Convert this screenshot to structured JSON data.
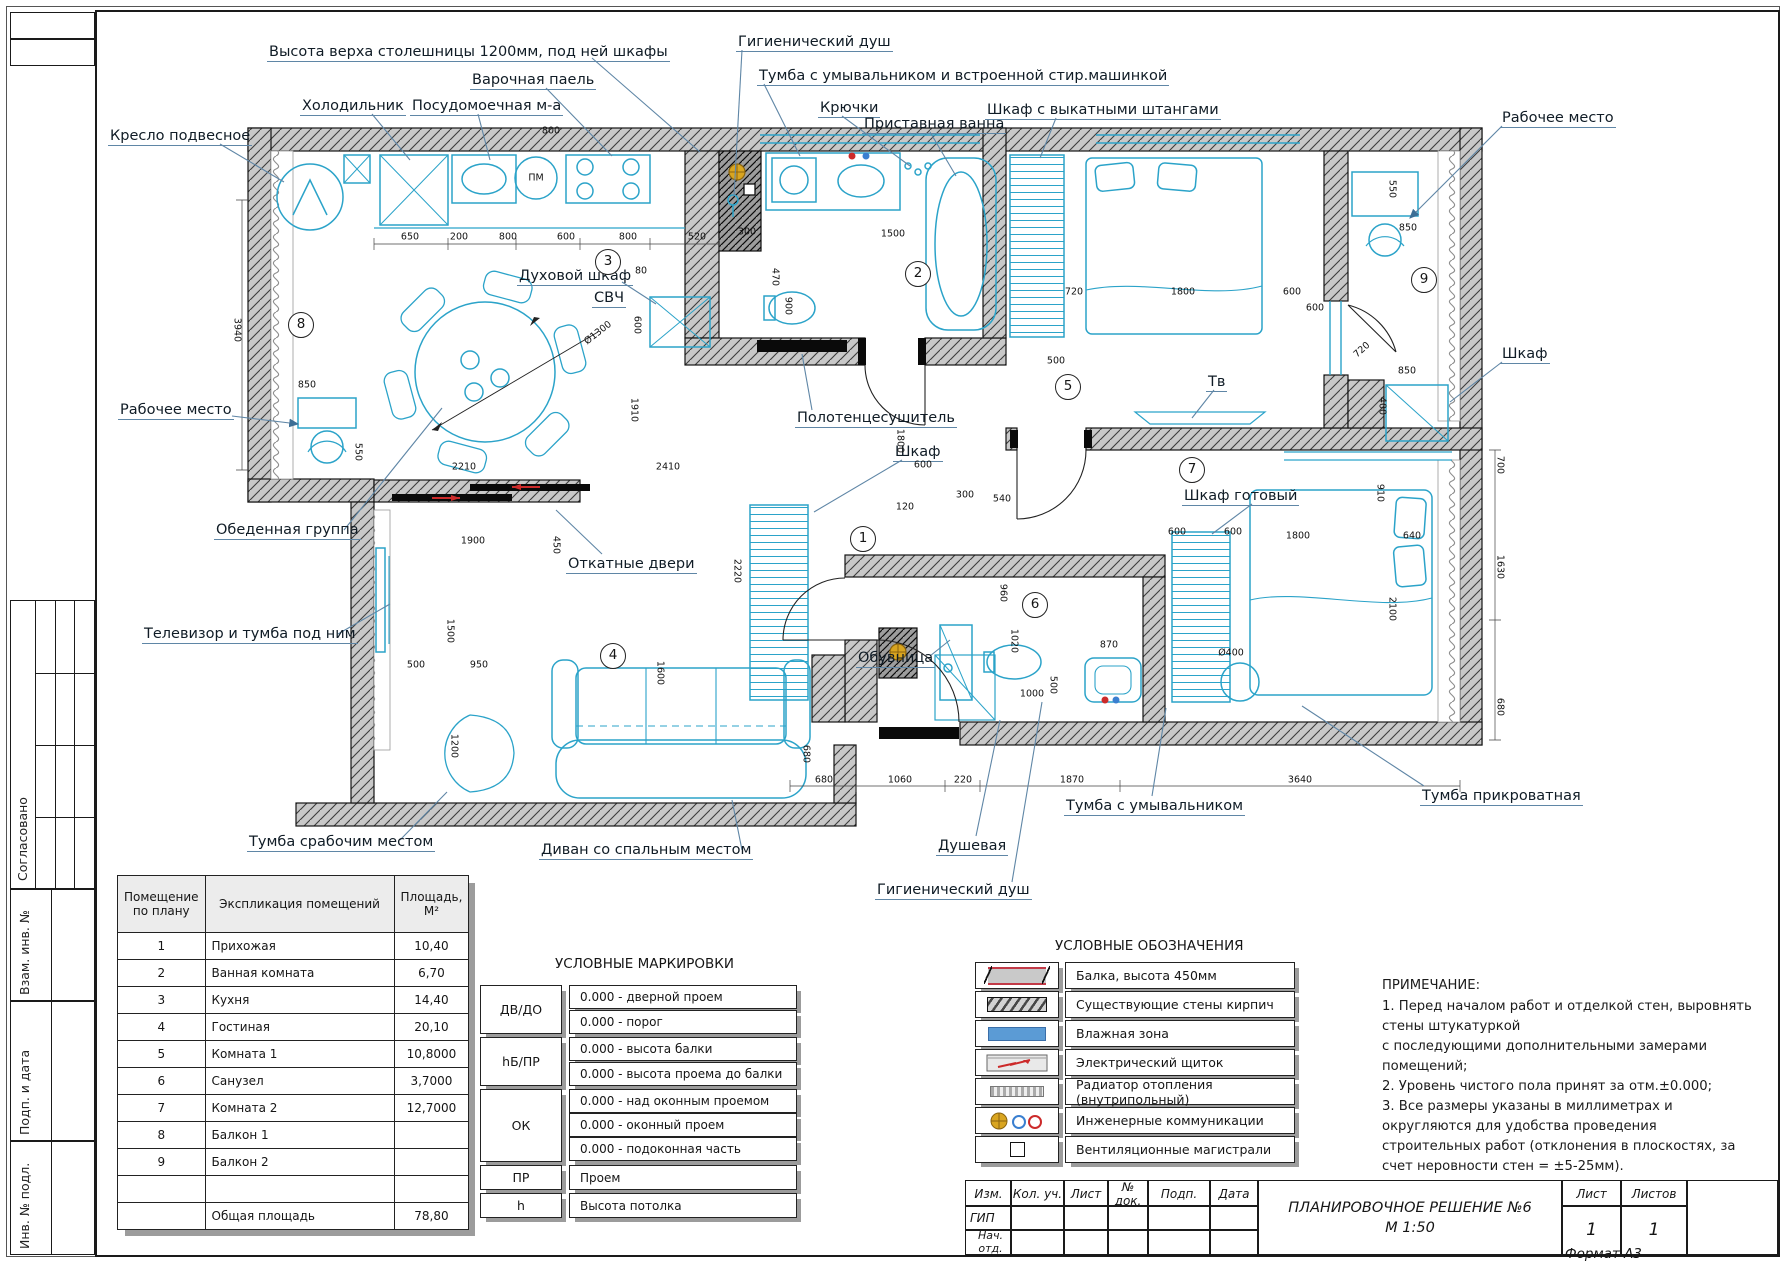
{
  "drawing": {
    "title_line1": "ПЛАНИРОВОЧНОЕ РЕШЕНИЕ №6",
    "title_line2": "М 1:50",
    "format": "Формат А3"
  },
  "stamp_left": {
    "approved": "Согласовано",
    "vzam": "Взам. инв. №",
    "podp": "Подп. и дата",
    "inv": "Инв. № подл."
  },
  "callouts": [
    {
      "t": "Высота верха столешницы 1200мм, под ней шкафы",
      "x": 267,
      "y": 44,
      "sx": 592,
      "sy": 58,
      "tx": 700,
      "ty": 152
    },
    {
      "t": "Гигиенический душ",
      "x": 736,
      "y": 34,
      "sx": 742,
      "sy": 50,
      "tx": 734,
      "ty": 196
    },
    {
      "t": "Тумба с умывальником и встроенной стир.машинкой",
      "x": 757,
      "y": 68,
      "sx": 764,
      "sy": 84,
      "tx": 800,
      "ty": 156
    },
    {
      "t": "Варочная паель",
      "x": 470,
      "y": 72,
      "sx": 546,
      "sy": 88,
      "tx": 612,
      "ty": 156
    },
    {
      "t": "Холодильник",
      "x": 300,
      "y": 98,
      "sx": 372,
      "sy": 114,
      "tx": 410,
      "ty": 160
    },
    {
      "t": "Посудомоечная м-а",
      "x": 410,
      "y": 98,
      "sx": 478,
      "sy": 114,
      "tx": 490,
      "ty": 160
    },
    {
      "t": "Крючки",
      "x": 818,
      "y": 100,
      "sx": 842,
      "sy": 116,
      "tx": 910,
      "ty": 166
    },
    {
      "t": "Приставная ванна",
      "x": 862,
      "y": 116,
      "sx": 930,
      "sy": 132,
      "tx": 956,
      "ty": 176
    },
    {
      "t": "Шкаф с выкатными штангами",
      "x": 985,
      "y": 102,
      "sx": 1056,
      "sy": 118,
      "tx": 1040,
      "ty": 158
    },
    {
      "t": "Рабочее место",
      "x": 1500,
      "y": 110,
      "sx": 1502,
      "sy": 126,
      "tx": 1410,
      "ty": 218,
      "a": 1
    },
    {
      "t": "Кресло подвесное",
      "x": 108,
      "y": 128,
      "sx": 220,
      "sy": 144,
      "tx": 284,
      "ty": 182
    },
    {
      "t": "Духовой шкаф",
      "x": 517,
      "y": 268,
      "sx": 622,
      "sy": 282,
      "tx": 656,
      "ty": 304
    },
    {
      "t": "СВЧ",
      "x": 592,
      "y": 290
    },
    {
      "t": "Рабочее место",
      "x": 118,
      "y": 402,
      "sx": 232,
      "sy": 416,
      "tx": 298,
      "ty": 424,
      "a": 1
    },
    {
      "t": "Полотенцесушитель",
      "x": 795,
      "y": 410,
      "sx": 812,
      "sy": 410,
      "tx": 802,
      "ty": 354
    },
    {
      "t": "Шкаф",
      "x": 893,
      "y": 444,
      "sx": 902,
      "sy": 460,
      "tx": 814,
      "ty": 512
    },
    {
      "t": "Тв",
      "x": 1206,
      "y": 374,
      "sx": 1214,
      "sy": 390,
      "tx": 1192,
      "ty": 418
    },
    {
      "t": "Шкаф",
      "x": 1500,
      "y": 346,
      "sx": 1502,
      "sy": 362,
      "tx": 1450,
      "ty": 402
    },
    {
      "t": "Обеденная группа",
      "x": 214,
      "y": 522,
      "sx": 344,
      "sy": 530,
      "tx": 442,
      "ty": 408
    },
    {
      "t": "Откатные двери",
      "x": 566,
      "y": 556,
      "sx": 602,
      "sy": 554,
      "tx": 556,
      "ty": 510
    },
    {
      "t": "Шкаф готовый",
      "x": 1182,
      "y": 488,
      "sx": 1252,
      "sy": 504,
      "tx": 1212,
      "ty": 534
    },
    {
      "t": "Телевизор и тумба под ним",
      "x": 142,
      "y": 626,
      "sx": 338,
      "sy": 634,
      "tx": 390,
      "ty": 604
    },
    {
      "t": "Обувница",
      "x": 856,
      "y": 650,
      "sx": 930,
      "sy": 656,
      "tx": 950,
      "ty": 640
    },
    {
      "t": "Тумба срабочим местом",
      "x": 247,
      "y": 834,
      "sx": 400,
      "sy": 840,
      "tx": 447,
      "ty": 792
    },
    {
      "t": "Диван со  спальным местом",
      "x": 539,
      "y": 842,
      "sx": 742,
      "sy": 850,
      "tx": 732,
      "ty": 800
    },
    {
      "t": "Душевая",
      "x": 936,
      "y": 838,
      "sx": 976,
      "sy": 836,
      "tx": 1000,
      "ty": 720
    },
    {
      "t": "Гигиенический душ",
      "x": 875,
      "y": 882,
      "sx": 1012,
      "sy": 882,
      "tx": 1042,
      "ty": 702
    },
    {
      "t": "Тумба с умывальником",
      "x": 1064,
      "y": 798,
      "sx": 1152,
      "sy": 796,
      "tx": 1166,
      "ty": 708
    },
    {
      "t": "Тумба прикроватная",
      "x": 1420,
      "y": 788,
      "sx": 1424,
      "sy": 786,
      "tx": 1302,
      "ty": 706
    }
  ],
  "rooms": [
    [
      "1",
      862,
      538
    ],
    [
      "2",
      917,
      273
    ],
    [
      "3",
      607,
      261
    ],
    [
      "4",
      612,
      655
    ],
    [
      "5",
      1067,
      386
    ],
    [
      "6",
      1034,
      604
    ],
    [
      "7",
      1191,
      469
    ],
    [
      "8",
      300,
      324
    ],
    [
      "9",
      1423,
      279
    ]
  ],
  "dims": [
    [
      "650",
      410,
      237,
      0
    ],
    [
      "200",
      459,
      237,
      0
    ],
    [
      "800",
      508,
      237,
      0
    ],
    [
      "600",
      566,
      237,
      0
    ],
    [
      "800",
      628,
      237,
      0
    ],
    [
      "520",
      697,
      237,
      0
    ],
    [
      "800",
      551,
      131,
      0
    ],
    [
      "300",
      747,
      232,
      0
    ],
    [
      "1500",
      893,
      234,
      0
    ],
    [
      "470",
      775,
      277,
      90
    ],
    [
      "900",
      788,
      306,
      90
    ],
    [
      "80",
      641,
      271,
      0
    ],
    [
      "600",
      637,
      325,
      90
    ],
    [
      "720",
      1074,
      292,
      0
    ],
    [
      "1800",
      1183,
      292,
      0
    ],
    [
      "600",
      1292,
      292,
      0
    ],
    [
      "550",
      1392,
      189,
      90
    ],
    [
      "850",
      1408,
      228,
      0
    ],
    [
      "600",
      1315,
      308,
      0
    ],
    [
      "720",
      1362,
      350,
      -42
    ],
    [
      "850",
      1407,
      371,
      0
    ],
    [
      "400",
      1382,
      406,
      90
    ],
    [
      "3940",
      237,
      330,
      90
    ],
    [
      "850",
      307,
      385,
      0
    ],
    [
      "550",
      358,
      452,
      90
    ],
    [
      "2210",
      464,
      467,
      0
    ],
    [
      "2410",
      668,
      467,
      0
    ],
    [
      "1910",
      634,
      410,
      90
    ],
    [
      "1900",
      473,
      541,
      0
    ],
    [
      "450",
      556,
      545,
      90
    ],
    [
      "500",
      416,
      665,
      0
    ],
    [
      "950",
      479,
      665,
      0
    ],
    [
      "1500",
      450,
      631,
      90
    ],
    [
      "1200",
      454,
      746,
      90
    ],
    [
      "1600",
      660,
      673,
      90
    ],
    [
      "120",
      905,
      507,
      0
    ],
    [
      "300",
      965,
      495,
      0
    ],
    [
      "540",
      1002,
      499,
      0
    ],
    [
      "500",
      1056,
      361,
      0
    ],
    [
      "1800",
      900,
      441,
      90
    ],
    [
      "600",
      923,
      465,
      0
    ],
    [
      "2220",
      737,
      571,
      90
    ],
    [
      "1020",
      1014,
      641,
      90
    ],
    [
      "960",
      1003,
      593,
      90
    ],
    [
      "1000",
      1032,
      694,
      0
    ],
    [
      "870",
      1109,
      645,
      0
    ],
    [
      "500",
      1053,
      685,
      90
    ],
    [
      "Ø400",
      1231,
      653,
      0
    ],
    [
      "1800",
      1298,
      536,
      0
    ],
    [
      "640",
      1412,
      536,
      0
    ],
    [
      "2100",
      1392,
      609,
      90
    ],
    [
      "600",
      1177,
      532,
      0
    ],
    [
      "600",
      1233,
      532,
      0
    ],
    [
      "910",
      1380,
      493,
      90
    ],
    [
      "700",
      1500,
      465,
      90
    ],
    [
      "1630",
      1500,
      567,
      90
    ],
    [
      "680",
      1500,
      707,
      90
    ],
    [
      "680",
      824,
      780,
      0
    ],
    [
      "1060",
      900,
      780,
      0
    ],
    [
      "220",
      963,
      780,
      0
    ],
    [
      "1870",
      1072,
      780,
      0
    ],
    [
      "3640",
      1300,
      780,
      0
    ],
    [
      "680",
      806,
      754,
      90
    ],
    [
      "Ø1300",
      598,
      333,
      -38
    ],
    [
      "ПМ",
      536,
      178,
      0
    ]
  ],
  "table": {
    "h1": "Помещение по плану",
    "h2": "Экспликация помещений",
    "h3": "Площадь, М²",
    "rows": [
      [
        "1",
        "Прихожая",
        "10,40"
      ],
      [
        "2",
        "Ванная комната",
        "6,70"
      ],
      [
        "3",
        "Кухня",
        "14,40"
      ],
      [
        "4",
        "Гостиная",
        "20,10"
      ],
      [
        "5",
        "Комната 1",
        "10,8000"
      ],
      [
        "6",
        "Санузел",
        "3,7000"
      ],
      [
        "7",
        "Комната 2",
        "12,7000"
      ],
      [
        "8",
        "Балкон 1",
        ""
      ],
      [
        "9",
        "Балкон 2",
        ""
      ],
      [
        "",
        "",
        ""
      ],
      [
        "",
        "Общая площадь",
        "78,80"
      ]
    ]
  },
  "markings": {
    "title": "УСЛОВНЫЕ МАРКИРОВКИ",
    "groups": [
      {
        "key": "ДВ/ДО",
        "lines": [
          "0.000 - дверной проем",
          "0.000 - порог"
        ]
      },
      {
        "key": "hБ/ПР",
        "lines": [
          "0.000 - высота балки",
          "0.000 - высота проема до балки"
        ]
      },
      {
        "key": "ОК",
        "lines": [
          "0.000 - над оконным проемом",
          "0.000 - оконный проем",
          "0.000 - подоконная часть"
        ]
      },
      {
        "key": "ПР",
        "lines": [
          "Проем"
        ]
      },
      {
        "key": "h",
        "lines": [
          "Высота потолка"
        ]
      }
    ]
  },
  "symbols": {
    "title": "УСЛОВНЫЕ ОБОЗНАЧЕНИЯ",
    "items": [
      {
        "icon": "beam-icon",
        "label": "Балка, высота 450мм"
      },
      {
        "icon": "brick-wall-icon",
        "label": "Существующие стены кирпич"
      },
      {
        "icon": "wet-zone-icon",
        "label": "Влажная зона"
      },
      {
        "icon": "electric-panel-icon",
        "label": "Электрический щиток"
      },
      {
        "icon": "floor-radiator-icon",
        "label": "Радиатор отопления (внутрипольный)"
      },
      {
        "icon": "utilities-icon",
        "label": "Инженерные коммуникации"
      },
      {
        "icon": "vent-duct-icon",
        "label": "Вентиляционные магистрали"
      }
    ]
  },
  "notes": {
    "title": "ПРИМЕЧАНИЕ:",
    "lines": [
      "1. Перед началом работ и отделкой стен, выровнять",
      "стены штукатуркой",
      "с последующими дополнительными замерами",
      "помещений;",
      "2. Уровень чистого пола принят за отм.±0.000;",
      "3.  Все  размеры  указаны  в  миллиметрах  и",
      "округляются    для    удобства    проведения",
      "строительных работ (отклонения в плоскостях, за",
      "счет неровности стен = ±5-25мм)."
    ]
  },
  "title_block": {
    "cols": [
      "Изм.",
      "Кол. уч.",
      "Лист",
      "№ док.",
      "Подп.",
      "Дата"
    ],
    "row1": "ГИП",
    "row2": "Нач. отд.",
    "sheet_label": "Лист",
    "sheets_label": "Листов",
    "sheet_value": "1",
    "sheets_value": "1"
  }
}
